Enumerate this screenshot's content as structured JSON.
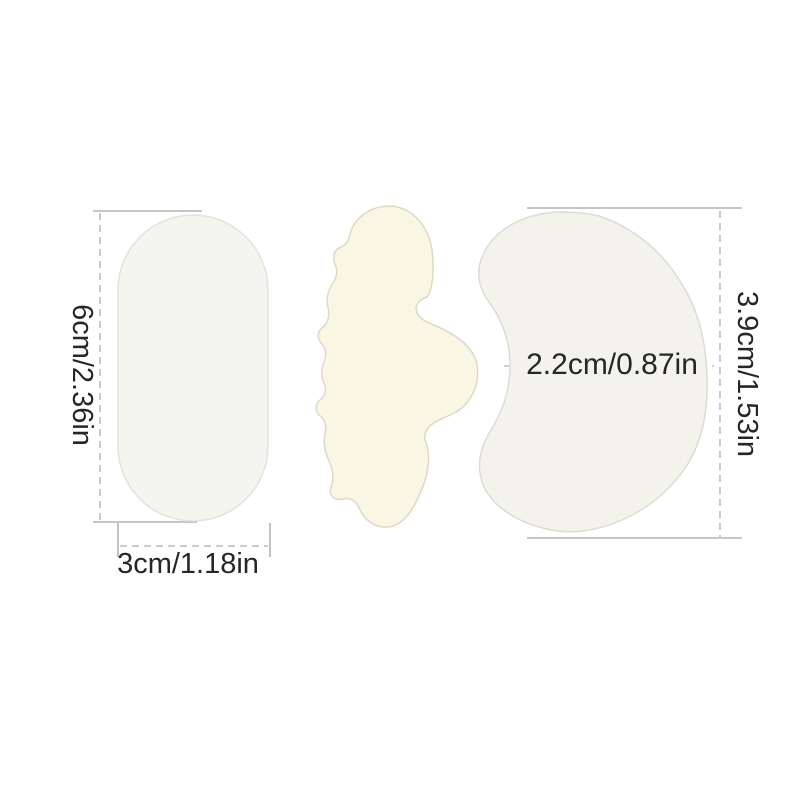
{
  "labels": {
    "oval_height": "6cm/2.36in",
    "oval_width": "3cm/1.18in",
    "crescent_width": "2.2cm/0.87in",
    "crescent_height": "3.9cm/1.53in"
  },
  "colors": {
    "background": "#ffffff",
    "oval_pad_fill": "#f5f5f0",
    "oval_pad_stroke": "#e3e3dc",
    "contour_pad_fill": "#faf6e4",
    "contour_pad_stroke": "#ded9c7",
    "crescent_pad_fill": "#f3f3ec",
    "crescent_pad_stroke": "#dcdcd4",
    "dimension_line": "#b3b3b0",
    "label_text": "#262626"
  }
}
